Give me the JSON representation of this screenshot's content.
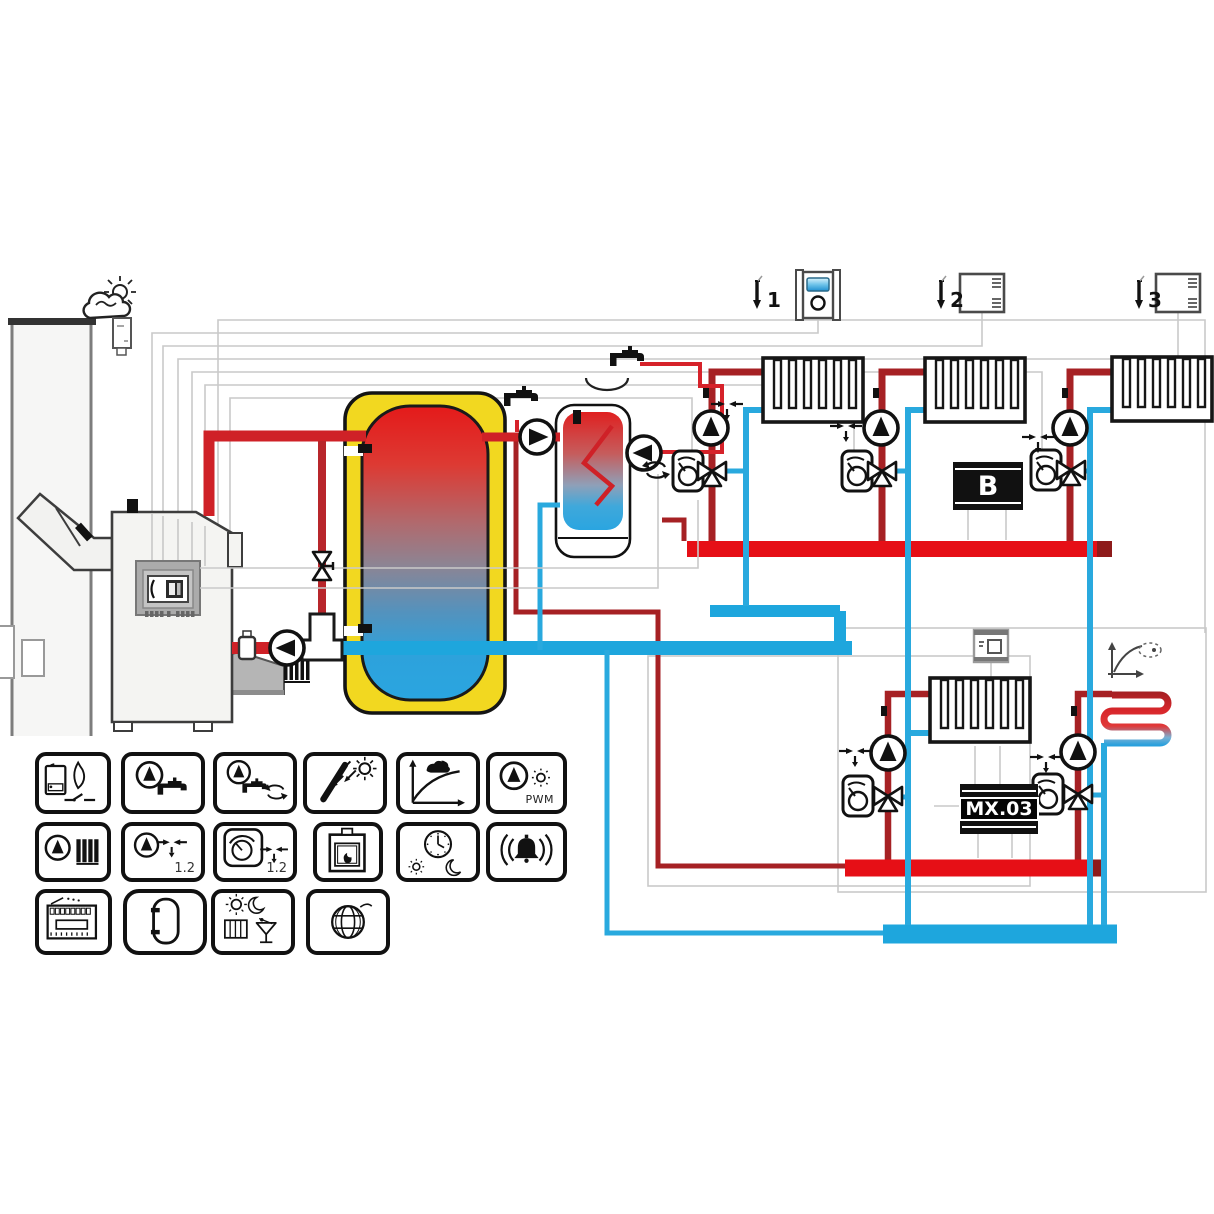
{
  "scheme": {
    "type": "heating-system-hydraulic-diagram",
    "sensors": [
      {
        "num": "1",
        "device": "room-controller-with-display"
      },
      {
        "num": "2",
        "device": "room-thermostat"
      },
      {
        "num": "3",
        "device": "room-thermostat"
      }
    ],
    "boxes": {
      "local_controller": "B",
      "extension_module": "MX.03"
    },
    "components": [
      "chimney",
      "flue-with-sensor",
      "pellet-boiler-with-controller",
      "burner",
      "boiler-return-pump",
      "anti-condensation-valve",
      "shut-off-valve",
      "buffer-tank",
      "dhw-tank-with-coil",
      "dhw-charge-pump",
      "circulation-pump",
      "tap",
      "tap-with-basin",
      "weather-sensor",
      "outdoor-sensor",
      "radiator-circuit-1",
      "radiator-circuit-2",
      "radiator-circuit-3",
      "radiator-circuit-4",
      "floor-heating-coil",
      "heating-curve-symbol",
      "room-stat-lower",
      "supply-manifold-upper",
      "return-manifold-upper",
      "supply-manifold-lower",
      "return-manifold-lower"
    ],
    "colors": {
      "supply_red": "#cf2127",
      "manifold_red": "#e60f16",
      "dark_red": "#a62124",
      "return_blue": "#29a9de",
      "buffer_yellow": "#f2d820",
      "tank_hot": "#e41a1a",
      "tank_cold": "#2aa5e0",
      "wiring_gray": "#c9c9c9"
    }
  },
  "legend": {
    "pwm_label": "PWM",
    "mix_label_1": "1.2",
    "mix_label_2": "1.2",
    "tiles": [
      "boiler-flame-contact-icon",
      "dhw-pump-tap-icon",
      "dhw-pump-circulation-icon",
      "solar-collector-icon",
      "heating-curve-icon",
      "pump-pwm-icon",
      "heating-pump-radiator-icon",
      "pump-mixing-valve-icon",
      "thermostat-mixing-valve-icon",
      "fireplace-icon",
      "clock-day-night-icon",
      "alarm-icon",
      "controller-module-icon",
      "buffer-tank-icon",
      "comfort-day-night-party-icon",
      "internet-globe-icon"
    ]
  }
}
